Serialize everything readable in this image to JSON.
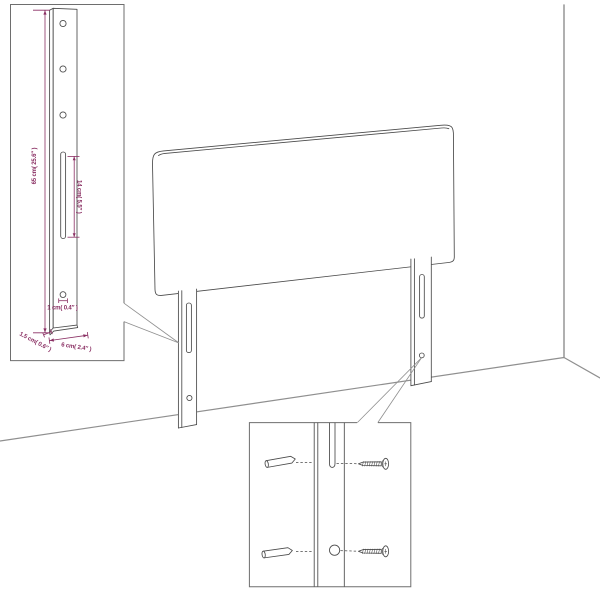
{
  "colors": {
    "dimension": "#8a2f63",
    "line": "#4a4a4a",
    "room": "#8f8f8f",
    "border": "#6e6e6e",
    "background": "#ffffff"
  },
  "figure": {
    "type": "product-assembly-dimension-diagram",
    "subject": "headboard with two slotted legs in room corner, leg dimension inset and wall-mounting hardware inset"
  },
  "labels": {
    "height": "65 cm( 25.6″ )",
    "slot_length": "14 cm( 5.5″ )",
    "hole_diameter": "1 cm( 0.4″ )",
    "leg_thickness": "1.5 cm( 0.6″ )",
    "leg_width": "6 cm( 2.4″ )"
  },
  "icons": {
    "anchor": "wall-anchor-icon",
    "screw": "screw-icon"
  }
}
